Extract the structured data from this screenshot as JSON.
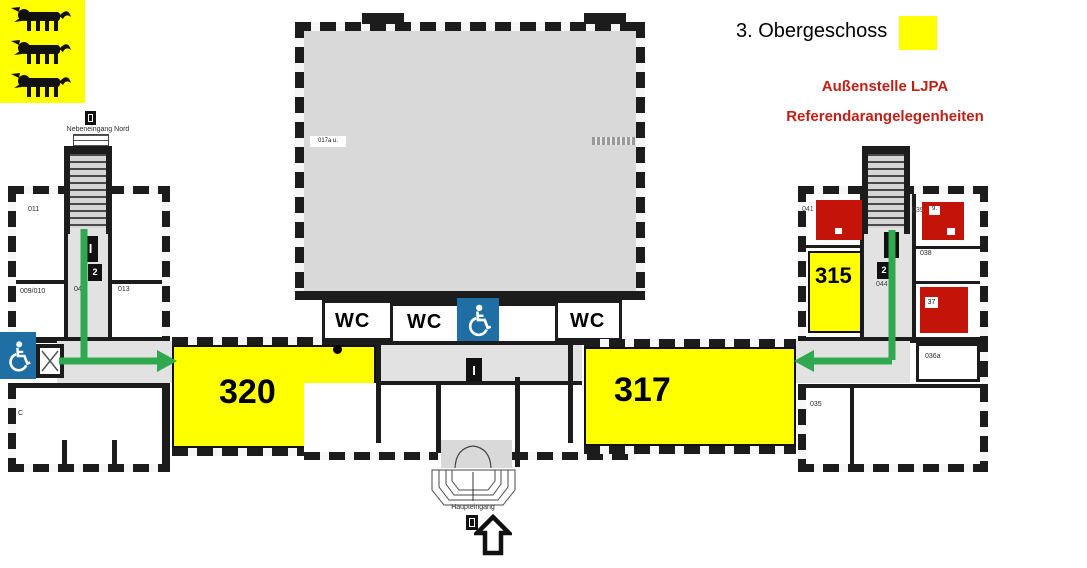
{
  "header": {
    "title": "3. Obergeschoss",
    "subtitle_line1": "Außenstelle LJPA",
    "subtitle_line2": "Referendarangelegenheiten"
  },
  "colors": {
    "highlight_yellow": "#ffff00",
    "marker_red": "#c41309",
    "route_green": "#2fa84f",
    "accessible_blue": "#1f6fa5",
    "subtitle_red": "#bf2117",
    "wall_dark": "#1c1c1c",
    "hall_gray": "#d9d9d9"
  },
  "entrances": {
    "north_label": "Nebeneingang Nord",
    "main_label": "Haupteingang"
  },
  "highlighted_rooms": {
    "r320": "320",
    "r317": "317",
    "r315": "315"
  },
  "wc": {
    "left": "WC",
    "middle": "WC",
    "right": "WC"
  },
  "left_wing_rooms": {
    "r011": "011",
    "r009_010": "009/010",
    "r045": "045",
    "r013": "013",
    "rC": "C"
  },
  "right_wing_rooms": {
    "r041": "041",
    "r039": "039",
    "r039_chip": "9.",
    "r038": "038",
    "r037_chip": "37",
    "r036a": "036a",
    "r035": "035",
    "r044": "044"
  },
  "hall": {
    "corner_label": "017a u."
  },
  "signs": {
    "door_sign_1": "I",
    "door_sign_2": "2"
  }
}
